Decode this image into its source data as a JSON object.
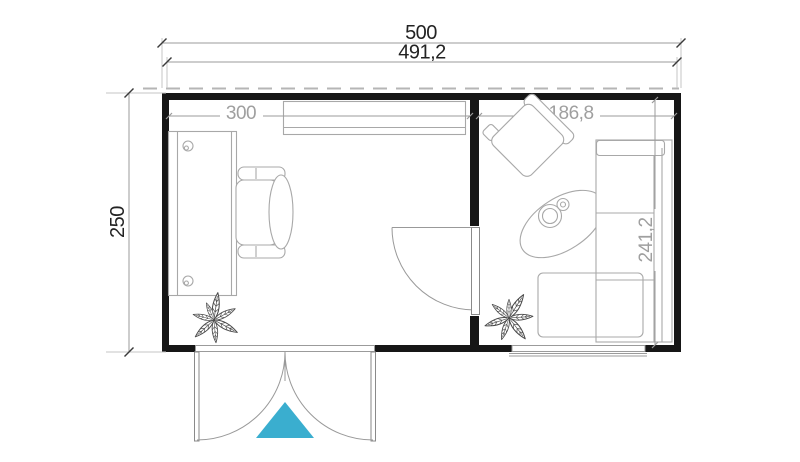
{
  "plan": {
    "dimensions": {
      "overall_width": "500",
      "frame_width": "491,2",
      "overall_depth": "250",
      "office_width": "300",
      "lounge_width": "186,8",
      "interior_depth": "241,2"
    },
    "colors": {
      "wall": "#161616",
      "dimension_line": "#9b9b9b",
      "dimension_text_dark": "#232323",
      "dimension_text_gray": "#9f9f9f",
      "furniture_line": "#a8a8a8",
      "plant_line": "#4a4a4a",
      "roof_dash": "#b5b5b5",
      "entrance_marker": "#3aaecf",
      "background": "#ffffff"
    },
    "furniture": {
      "office": [
        "desk",
        "office-chair",
        "wall-shelf",
        "plant"
      ],
      "lounge": [
        "armchair",
        "coffee-table",
        "corner-sofa",
        "plant"
      ]
    },
    "openings": [
      "entrance-double-door",
      "interior-door",
      "lounge-window"
    ]
  }
}
